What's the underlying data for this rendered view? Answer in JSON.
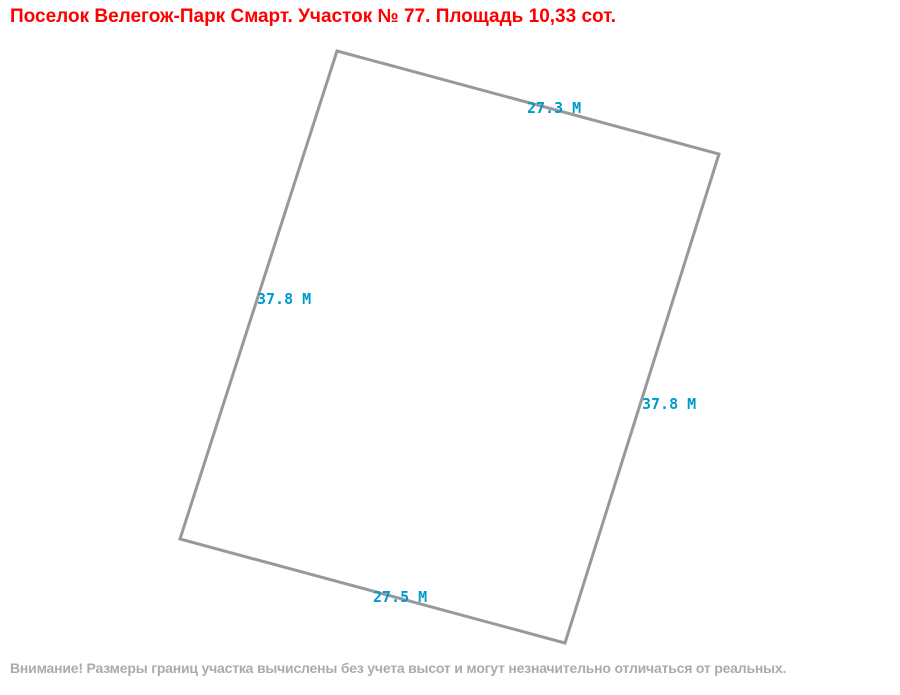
{
  "title": {
    "text": "Поселок Велегож-Парк Смарт. Участок № 77. Площадь 10,33 сот.",
    "color": "#ff0000"
  },
  "parcel": {
    "outline_color": "#999999",
    "outline_width": 3,
    "label_color": "#0099cc",
    "points": [
      {
        "x": 337,
        "y": 51
      },
      {
        "x": 719,
        "y": 154
      },
      {
        "x": 565,
        "y": 643
      },
      {
        "x": 180,
        "y": 539
      }
    ],
    "side_labels": [
      {
        "side": "top",
        "text": "27.3 М",
        "x": 527,
        "y": 101
      },
      {
        "side": "right",
        "text": "37.8 М",
        "x": 642,
        "y": 397
      },
      {
        "side": "bottom",
        "text": "27.5 М",
        "x": 373,
        "y": 590
      },
      {
        "side": "left",
        "text": "37.8 М",
        "x": 257,
        "y": 292
      }
    ]
  },
  "footer": {
    "text": "Внимание! Размеры границ участка вычислены без учета высот и могут незначительно отличаться от реальных.",
    "color": "#ababab"
  }
}
